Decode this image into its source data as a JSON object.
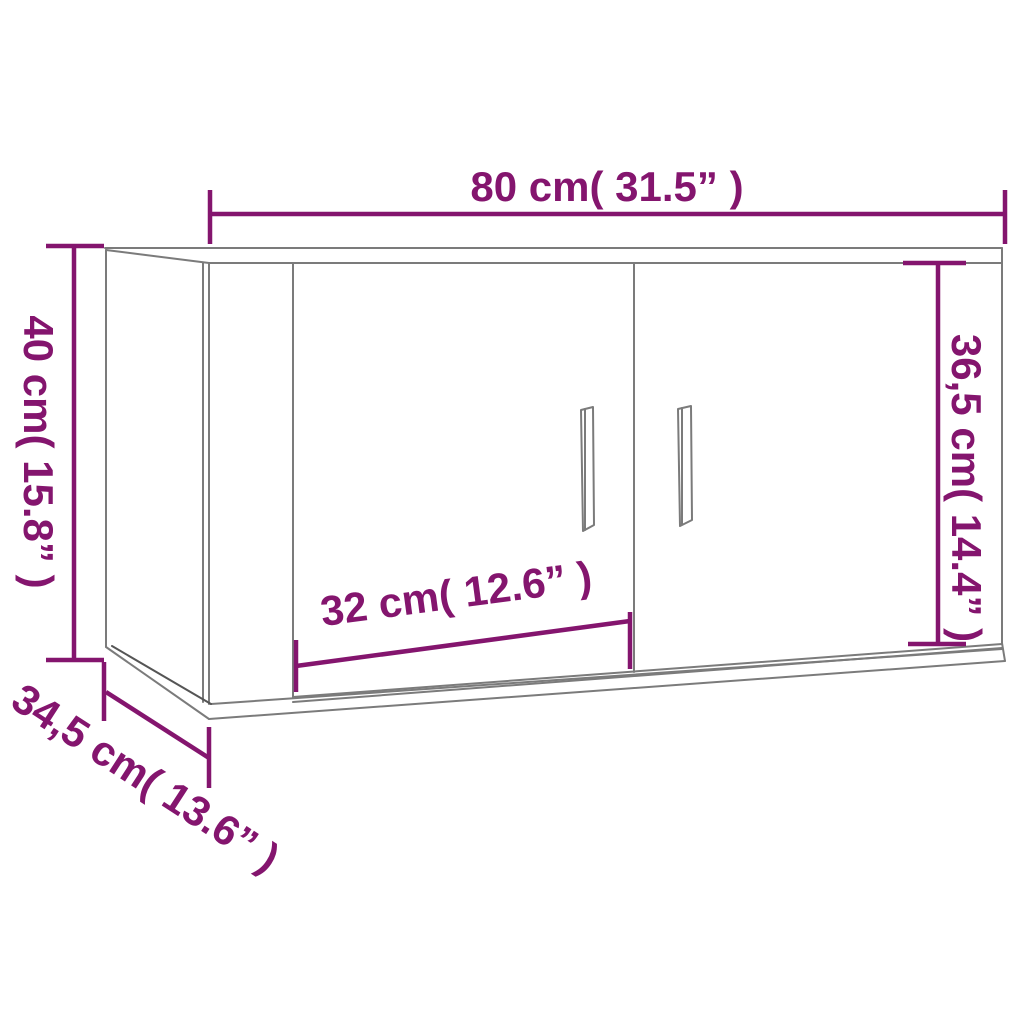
{
  "diagram": {
    "type": "product-dimension-drawing",
    "subject": "wall-mounted TV cabinet with two doors",
    "background_color": "#ffffff",
    "accent_color": "#84156e",
    "line_color": "#7b7b7b",
    "dimensions": {
      "width": {
        "label": "80 cm( 31.5” )",
        "cm": "80",
        "inches": "31.5",
        "position": "top"
      },
      "height": {
        "label": "40 cm( 15.8” )",
        "cm": "40",
        "inches": "15.8",
        "position": "left"
      },
      "door_height": {
        "label": "36,5 cm( 14.4” )",
        "cm": "36,5",
        "inches": "14.4",
        "position": "right"
      },
      "door_width": {
        "label": "32 cm( 12.6” )",
        "cm": "32",
        "inches": "12.6",
        "position": "bottom-middle"
      },
      "depth": {
        "label": "34,5 cm( 13.6” )",
        "cm": "34,5",
        "inches": "13.6",
        "position": "bottom-left-diagonal"
      }
    }
  }
}
